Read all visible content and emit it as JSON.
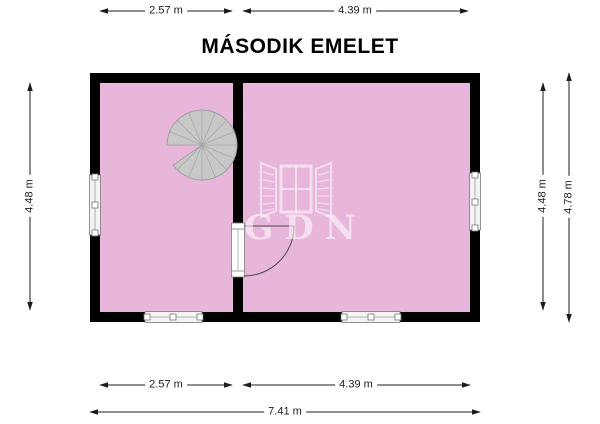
{
  "title": "MÁSODIK EMELET",
  "watermark": {
    "text": "GDN",
    "icon": "open-window-icon"
  },
  "dimensions": {
    "top": [
      {
        "label": "2.57 m"
      },
      {
        "label": "4.39 m"
      }
    ],
    "left": [
      {
        "label": "4.48 m"
      }
    ],
    "right": [
      {
        "label": "4.48 m"
      },
      {
        "label": "4.78 m"
      }
    ],
    "bottom": [
      {
        "label": "2.57 m"
      },
      {
        "label": "4.39 m"
      }
    ],
    "bottom_total": {
      "label": "7.41 m"
    }
  },
  "plan": {
    "rooms": 2,
    "features": [
      "spiral-staircase",
      "interior-door-with-swing",
      "window-left-wall",
      "window-right-wall",
      "window-bottom-left",
      "window-bottom-right"
    ]
  },
  "colors": {
    "background": "#FFFFFF",
    "room_fill": "#E8B6DB",
    "wall": "#000000",
    "staircase_fill": "#C8C8C8",
    "staircase_line": "#9E9E9E",
    "dimension_line": "#2A2A2A",
    "watermark": "rgba(255,255,255,0.55)"
  }
}
